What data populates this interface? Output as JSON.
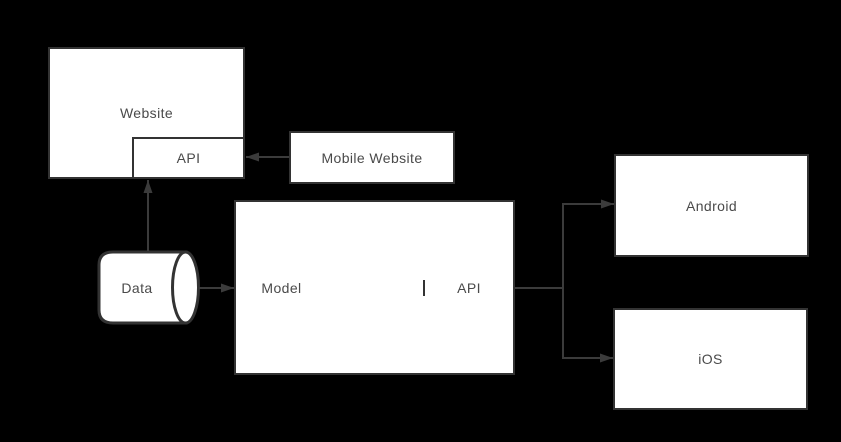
{
  "diagram": {
    "background_color": "#000000",
    "shape_fill": "#ffffff",
    "stroke_color": "#333333",
    "connector_color": "#3b3b3b",
    "label_color": "#4a4a4a",
    "nodes": {
      "website": {
        "label": "Website",
        "shape": "rectangle"
      },
      "website_api": {
        "label": "API",
        "shape": "rectangle"
      },
      "mobile_website": {
        "label": "Mobile Website",
        "shape": "rectangle"
      },
      "data_store": {
        "label": "Data",
        "shape": "cylinder"
      },
      "backend": {
        "shape": "rectangle",
        "sections": [
          {
            "label": "Model"
          },
          {
            "label": ""
          },
          {
            "label": "API"
          }
        ]
      },
      "android": {
        "label": "Android",
        "shape": "rectangle"
      },
      "ios": {
        "label": "iOS",
        "shape": "rectangle"
      }
    },
    "connections": [
      {
        "from": "mobile-website",
        "to": "website-api",
        "direction": "left"
      },
      {
        "from": "data-store",
        "to": "website-api",
        "direction": "up"
      },
      {
        "from": "data-store",
        "to": "backend-model",
        "direction": "right"
      },
      {
        "from": "backend-api",
        "to": "android",
        "direction": "right"
      },
      {
        "from": "backend-api",
        "to": "ios",
        "direction": "right"
      }
    ]
  }
}
